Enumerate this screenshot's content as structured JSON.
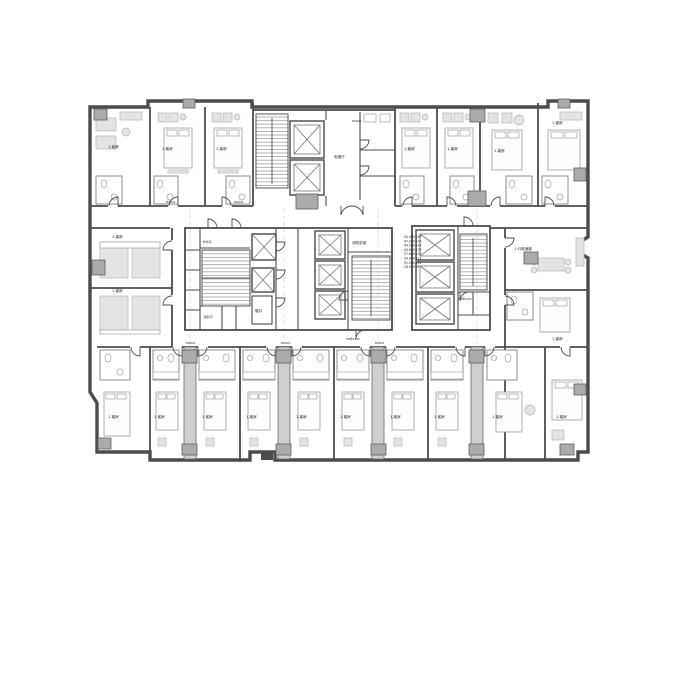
{
  "colors": {
    "wall": "#4c4c4c",
    "column": "#ababab",
    "furniture_fill": "#e4e4e4",
    "furniture_line": "#b5b5b5",
    "grid": "#d9d9d9",
    "text": "#1a1a1a",
    "background": "#ffffff"
  },
  "labels": {
    "guest_room": "1-客房",
    "exec_lounge": "1-行政酒廊",
    "elevator_lobby": "电梯厅",
    "fire_lobby": "消防前室",
    "duct": "管井",
    "linen_room": "布草间",
    "service_room": "服务间",
    "fire_door_tag": "FM甲1021",
    "door_tag": "M1021"
  },
  "levels": {
    "entries": [
      "50.400 16F",
      "47.200 15F",
      "44.000 14F",
      "40.800 13F",
      "37.600 12F",
      "34.400 11F",
      "31.200 10F",
      "28.000 9F"
    ]
  }
}
